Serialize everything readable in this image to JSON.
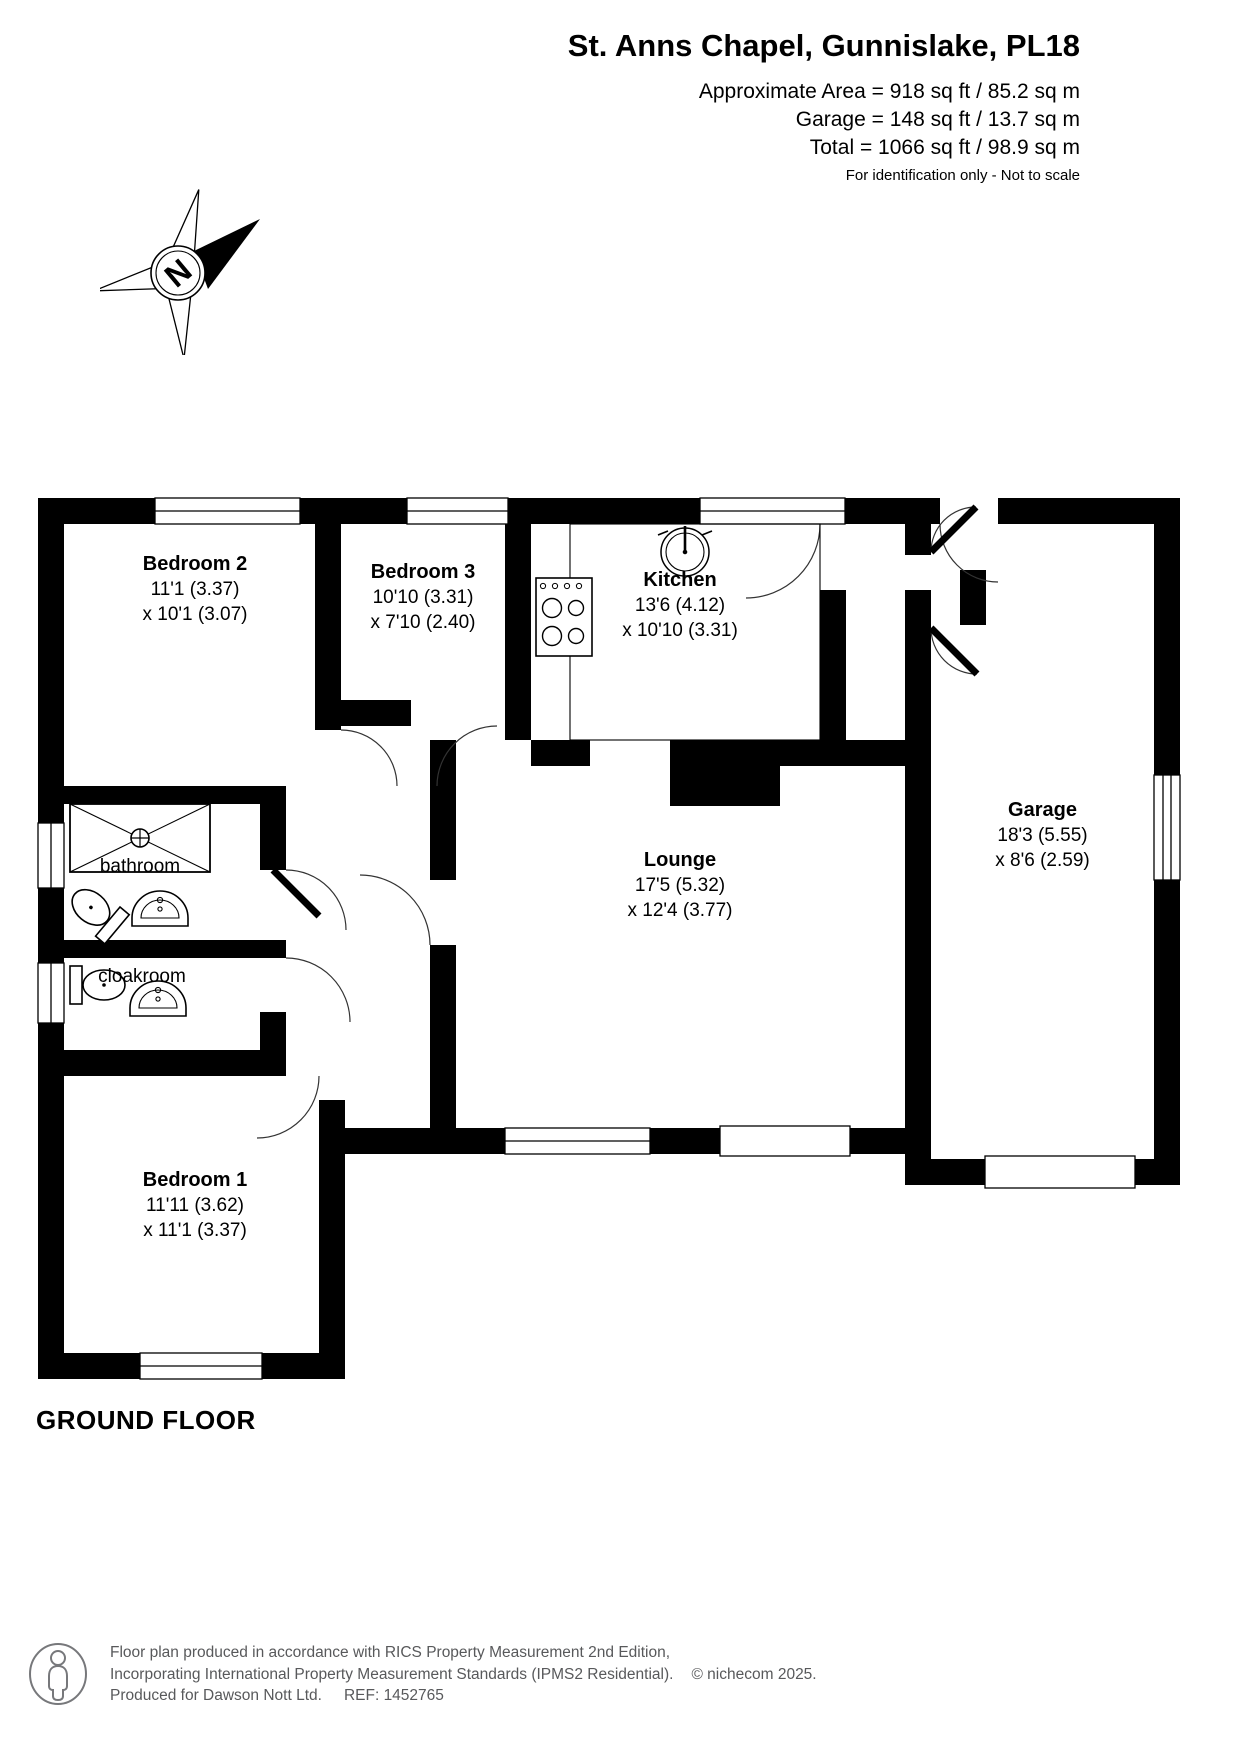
{
  "header": {
    "title": "St. Anns Chapel, Gunnislake, PL18",
    "area_line1": "Approximate Area = 918 sq ft / 85.2 sq m",
    "area_line2": "Garage = 148 sq ft / 13.7 sq m",
    "area_line3": "Total = 1066 sq ft / 98.9 sq m",
    "disclaimer": "For identification only - Not to scale"
  },
  "compass": {
    "label": "N"
  },
  "floor": {
    "label": "GROUND FLOOR"
  },
  "rooms": [
    {
      "id": "bedroom2",
      "name": "Bedroom 2",
      "dim1": "11'1 (3.37)",
      "dim2": "x 10'1 (3.07)"
    },
    {
      "id": "bedroom3",
      "name": "Bedroom 3",
      "dim1": "10'10 (3.31)",
      "dim2": "x 7'10 (2.40)"
    },
    {
      "id": "kitchen",
      "name": "Kitchen",
      "dim1": "13'6 (4.12)",
      "dim2": "x 10'10 (3.31)"
    },
    {
      "id": "garage",
      "name": "Garage",
      "dim1": "18'3 (5.55)",
      "dim2": "x 8'6 (2.59)"
    },
    {
      "id": "lounge",
      "name": "Lounge",
      "dim1": "17'5 (5.32)",
      "dim2": "x 12'4 (3.77)"
    },
    {
      "id": "bedroom1",
      "name": "Bedroom 1",
      "dim1": "11'11 (3.62)",
      "dim2": "x 11'1 (3.37)"
    },
    {
      "id": "bathroom",
      "name": "bathroom"
    },
    {
      "id": "cloakroom",
      "name": "cloakroom"
    }
  ],
  "footer": {
    "line1": "Floor plan produced in accordance with RICS Property Measurement 2nd Edition,",
    "line2": "Incorporating International Property Measurement Standards (IPMS2 Residential).",
    "copyright": "© nichecom 2025.",
    "line3_left": "Produced for Dawson Nott Ltd.",
    "line3_ref": "REF:  1452765"
  },
  "colors": {
    "wall": "#000000",
    "text": "#000000",
    "footer_text": "#58595b"
  }
}
